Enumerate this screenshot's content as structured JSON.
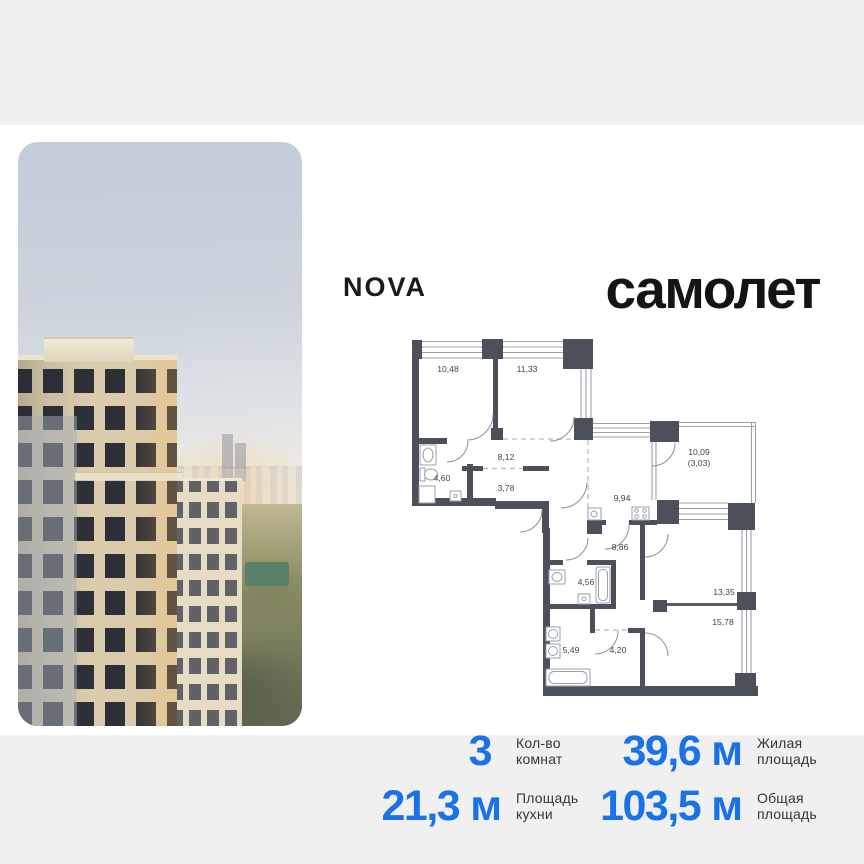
{
  "header": {
    "nova_logo": "NOVA",
    "samolet_logo": "самолет"
  },
  "floor_plan": {
    "rooms": [
      {
        "area": "10,48"
      },
      {
        "area": "11,33"
      },
      {
        "area": "8,12"
      },
      {
        "area": "4,60"
      },
      {
        "area": "3,78"
      },
      {
        "area": "9,94"
      },
      {
        "area": "10,09",
        "area_secondary": "(3,03)"
      },
      {
        "area": "8,86"
      },
      {
        "area": "4,56"
      },
      {
        "area": "13,35"
      },
      {
        "area": "15,78"
      },
      {
        "area": "5,49"
      },
      {
        "area": "4,20"
      }
    ]
  },
  "stats": {
    "rooms": {
      "value": "3",
      "unit": "",
      "label_line1": "Кол-во",
      "label_line2": "комнат"
    },
    "living": {
      "value": "39,6",
      "unit": "м",
      "label_line1": "Жилая",
      "label_line2": "площадь"
    },
    "kitchen": {
      "value": "21,3",
      "unit": "м",
      "label_line1": "Площадь",
      "label_line2": "кухни"
    },
    "total": {
      "value": "103,5",
      "unit": "м",
      "label_line1": "Общая",
      "label_line2": "площадь"
    }
  },
  "colors": {
    "accent_blue": "#1a72e8",
    "wall_dark": "#4c505a",
    "page_bg": "#f0f0f0",
    "card_bg": "#ffffff"
  }
}
